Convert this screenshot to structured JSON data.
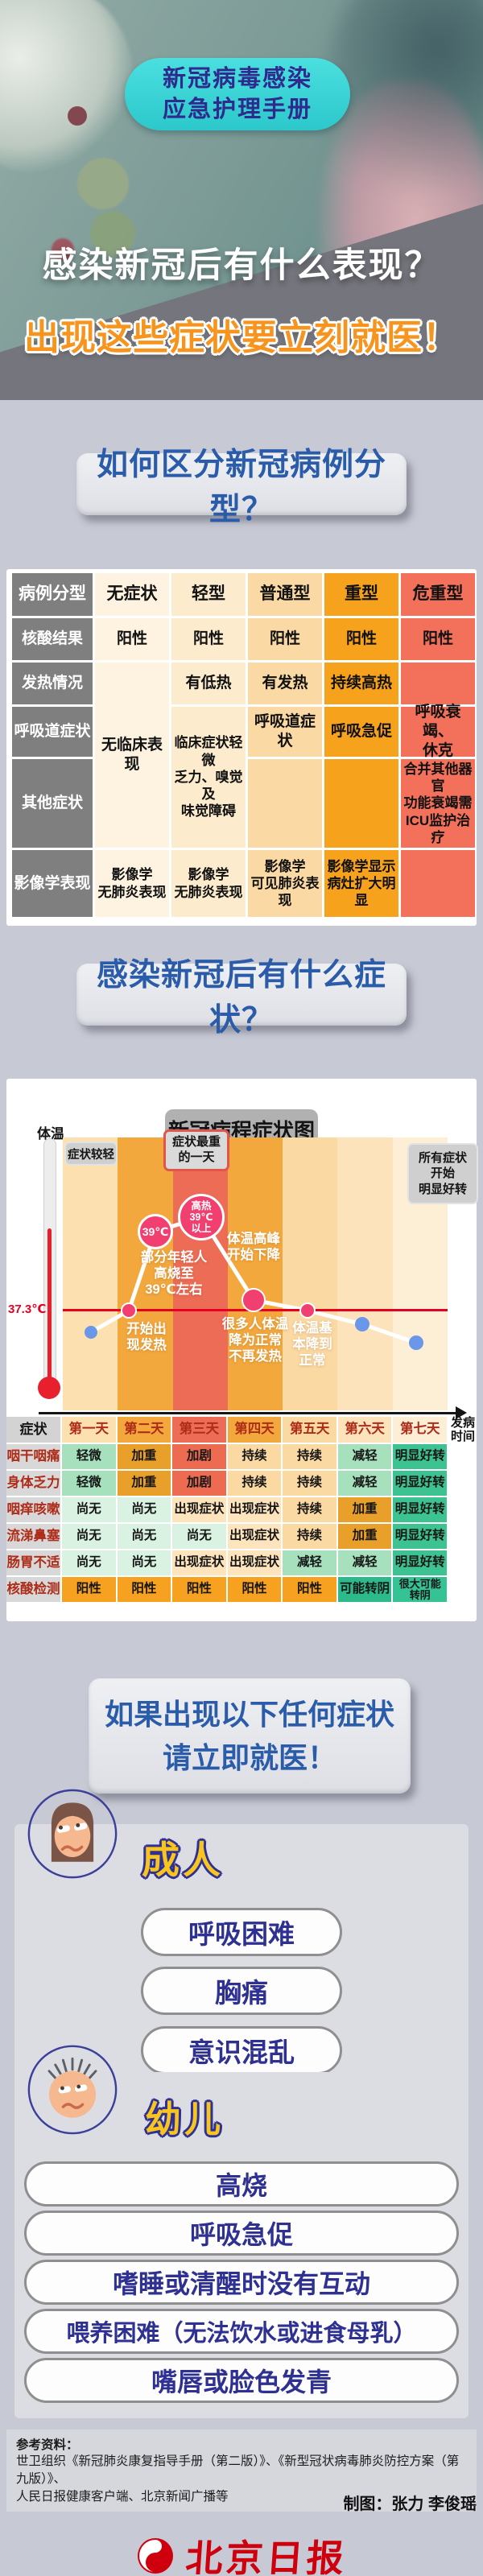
{
  "colors": {
    "accent_cyan": "#3bd6d6",
    "accent_navy": "#2f2a8e",
    "accent_orange": "#f7941e",
    "heading_blue": "#2a5caa",
    "alert_red": "#e60021",
    "logo_red": "#cf000e"
  },
  "hero": {
    "badge_line1": "新冠病毒感染",
    "badge_line2": "应急护理手册",
    "title_white": "感染新冠后有什么表现？",
    "title_orange": "出现这些症状要立刻就医！"
  },
  "s1": {
    "heading": "如何区分新冠病例分型？",
    "table": {
      "col_headers": [
        "病例分型",
        "无症状",
        "轻型",
        "普通型",
        "重型",
        "危重型"
      ],
      "row_labels": [
        "核酸结果",
        "发热情况",
        "呼吸道症状",
        "其他症状",
        "影像学表现"
      ],
      "nucleic": [
        "阳性",
        "阳性",
        "阳性",
        "阳性",
        "阳性"
      ],
      "fever_mild": "有低热",
      "fever_moderate": "有发热",
      "fever_severe": "持续高热",
      "asym_span": "无临床表现",
      "mild_span": "临床症状轻微\n乏力、嗅觉及\n味觉障碍",
      "resp_moderate": "呼吸道症状",
      "resp_severe": "呼吸急促",
      "resp_critical": "呼吸衰竭、\n休克",
      "other_critical": "合并其他器官\n功能衰竭需\nICU监护治疗",
      "imaging": [
        "影像学\n无肺炎表现",
        "影像学\n无肺炎表现",
        "影像学\n可见肺炎表现",
        "影像学显示\n病灶扩大明显",
        ""
      ]
    }
  },
  "s2": {
    "heading": "感染新冠后有什么症状？",
    "chart_title": "新冠病程症状图",
    "temp_label": "体温",
    "threshold": "37.3℃",
    "axis_label": "发病\n时间",
    "badge_left": "症状较轻",
    "badge_peak": "症状最重\n的一天",
    "badge_right": "所有症状\n开始\n明显好转",
    "bubble39": "39℃",
    "bubble_peak": "高热\n39℃\n以上",
    "ann_young": "部分年轻人\n高烧至\n39℃左右",
    "ann_peak_drop": "体温高峰\n开始下降",
    "ann_fever_start": "开始出\n现发热",
    "ann_normal": "很多人体温\n降为正常\n不再发热",
    "ann_basic_normal": "体温基\n本降到\n正常",
    "corner": "症状",
    "days": [
      "第一天",
      "第二天",
      "第三天",
      "第四天",
      "第五天",
      "第六天",
      "第七天"
    ],
    "rows": [
      {
        "label": "咽干咽痛",
        "cells": [
          "轻微",
          "加重",
          "加剧",
          "持续",
          "持续",
          "减轻",
          "明显好转"
        ]
      },
      {
        "label": "身体乏力",
        "cells": [
          "轻微",
          "加重",
          "加剧",
          "持续",
          "持续",
          "减轻",
          "明显好转"
        ]
      },
      {
        "label": "咽痒咳嗽",
        "cells": [
          "尚无",
          "尚无",
          "出现症状",
          "出现症状",
          "持续",
          "加重",
          "明显好转"
        ]
      },
      {
        "label": "流涕鼻塞",
        "cells": [
          "尚无",
          "尚无",
          "尚无",
          "出现症状",
          "持续",
          "加重",
          "明显好转"
        ]
      },
      {
        "label": "肠胃不适",
        "cells": [
          "尚无",
          "尚无",
          "出现症状",
          "出现症状",
          "减轻",
          "减轻",
          "明显好转"
        ]
      },
      {
        "label": "核酸检测",
        "cells": [
          "阳性",
          "阳性",
          "阳性",
          "阳性",
          "阳性",
          "可能转阴",
          "很大可能\n转阴"
        ]
      }
    ]
  },
  "s3": {
    "heading_line1": "如果出现以下任何症状",
    "heading_line2": "请立即就医！",
    "adult": {
      "title": "成人",
      "items": [
        "呼吸困难",
        "胸痛",
        "意识混乱"
      ]
    },
    "child": {
      "title": "幼儿",
      "items": [
        "高烧",
        "呼吸急促",
        "嗜睡或清醒时没有互动",
        "喂养困难（无法饮水或进食母乳）",
        "嘴唇或脸色发青"
      ]
    }
  },
  "footer": {
    "ref_title": "参考资料：",
    "ref_body": "世卫组织《新冠肺炎康复指导手册（第二版）》、《新型冠状病毒肺炎防控方案（第九版）》、\n人民日报健康客户端、北京新闻广播等",
    "credit": "制图：张力 李俊瑶",
    "logo_text": "北京日报"
  },
  "chart_data": {
    "type": "line",
    "title": "新冠病程症状图",
    "xlabel": "发病时间",
    "ylabel": "体温",
    "x": [
      "第一天",
      "第二天",
      "第二至三天",
      "第三天",
      "第四天",
      "第五天",
      "第六天",
      "第七天"
    ],
    "y_temp_c": [
      36.8,
      37.3,
      39.0,
      39.5,
      37.6,
      37.3,
      37.0,
      36.7
    ],
    "threshold": {
      "label": "37.3℃",
      "value": 37.3
    },
    "day_band_colors": [
      "#fce0b0",
      "#f3a83d",
      "#ed6c55",
      "#f3a83d",
      "#fbd9a2",
      "#fce3bb",
      "#fdeed6"
    ],
    "point_colors": [
      "blue",
      "pink",
      "pink",
      "pink",
      "pink",
      "pink",
      "blue",
      "blue"
    ],
    "annotations": [
      "症状较轻",
      "症状最重的一天",
      "所有症状开始明显好转",
      "开始出现发热",
      "部分年轻人高烧至39℃左右",
      "39℃",
      "高热39℃以上",
      "体温高峰开始下降",
      "很多人体温降为正常不再发热",
      "体温基本降到正常"
    ],
    "legend_position": "none",
    "grid": false
  }
}
